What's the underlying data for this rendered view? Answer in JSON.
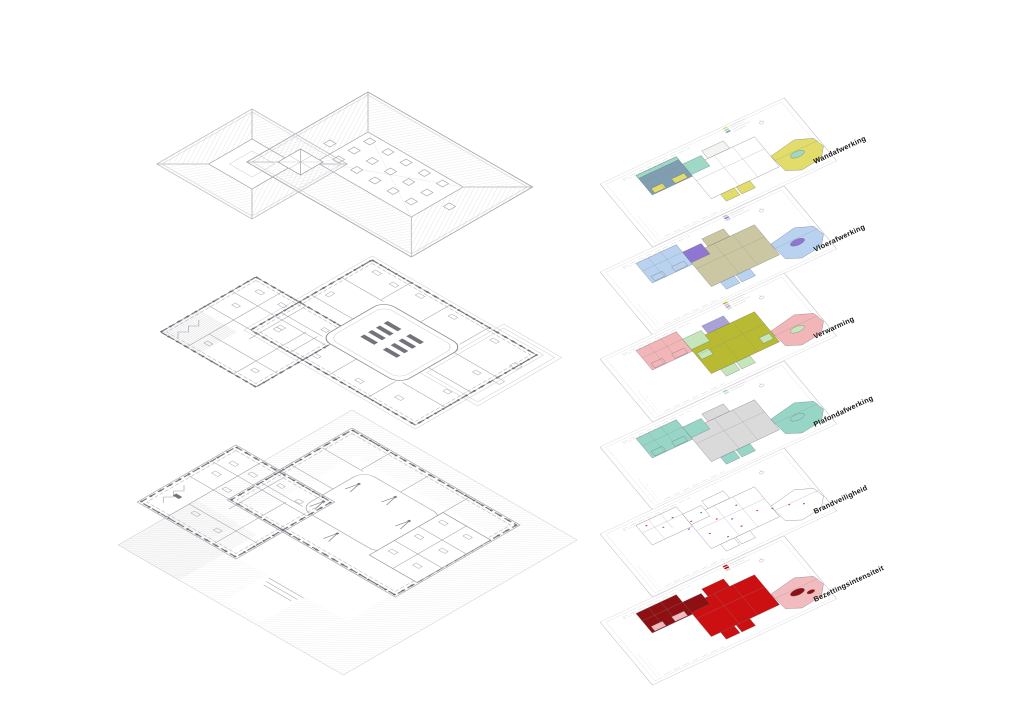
{
  "exploded_views": {
    "items": [
      {
        "id": "roof",
        "name": "roof-axonometric"
      },
      {
        "id": "upper-floor",
        "name": "upper-floor-axonometric"
      },
      {
        "id": "ground-floor",
        "name": "ground-floor-axonometric"
      }
    ]
  },
  "layers": {
    "label_color": "#141414",
    "items": [
      {
        "label": "Wandafwerking",
        "palette": {
          "west": "#7f9eb2",
          "north": "#f4f4f0",
          "central": "#ffffff",
          "accent": "#9ed8c6",
          "south": "#e2dc6a",
          "east": "#e2dc6a"
        }
      },
      {
        "label": "Vloerafwerking",
        "palette": {
          "west": "#b9d2ef",
          "north": "#cbc7a3",
          "central": "#cbc7a3",
          "accent": "#8f76d2",
          "south": "#b9d2ef",
          "east": "#b9d2ef"
        }
      },
      {
        "label": "Verwarming",
        "palette": {
          "west": "#f2b6b8",
          "north": "#a9a2d8",
          "central": "#b8ba32",
          "accent": "#c5e6ba",
          "south": "#c5e6ba",
          "east": "#f2b6b8"
        }
      },
      {
        "label": "Plafondafwerking",
        "palette": {
          "west": "#97d6c6",
          "north": "#dadada",
          "central": "#dadada",
          "accent": "#97d6c6",
          "south": "#97d6c6",
          "east": "#97d6c6"
        }
      },
      {
        "label": "Brandveiligheid",
        "palette": {
          "west": "#ffffff",
          "north": "#ffffff",
          "central": "#ffffff",
          "accent": "#ffffff",
          "south": "#ffffff",
          "east": "#ffffff"
        }
      },
      {
        "label": "Bezettingsintensiteit",
        "palette": {
          "west": "#8e1012",
          "north": "#cc1012",
          "central": "#cc1012",
          "accent": "#8e1012",
          "south": "#cc1012",
          "east": "#f2bcbe"
        }
      }
    ]
  },
  "fire_markers": {
    "red": "#d63a34",
    "green": "#3a9a46",
    "blue": "#4a63d4"
  }
}
